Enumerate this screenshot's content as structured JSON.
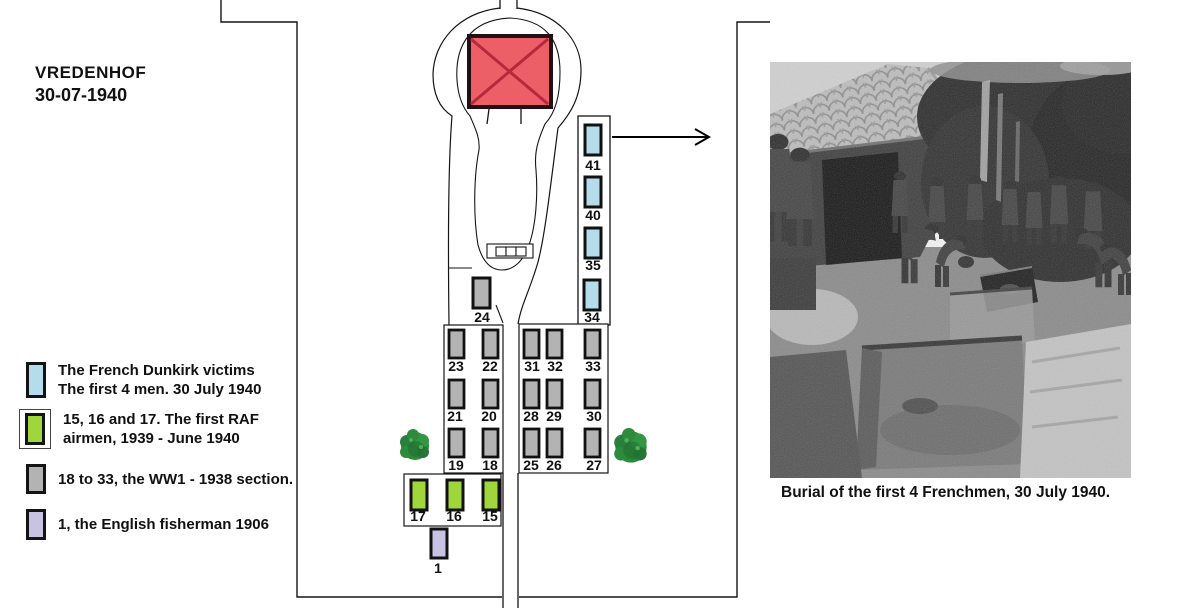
{
  "title": {
    "name": "VREDENHOF",
    "date": "30-07-1940"
  },
  "legend": {
    "items": [
      {
        "swatch": "french",
        "lines": [
          "The French Dunkirk victims",
          "The first 4 men. 30 July 1940"
        ]
      },
      {
        "swatch": "raf",
        "lines": [
          "15, 16 and 17. The first RAF",
          "airmen, 1939 - June 1940"
        ]
      },
      {
        "swatch": "ww1",
        "lines": [
          "18 to 33, the WW1 - 1938 section."
        ]
      },
      {
        "swatch": "fisherman",
        "lines": [
          "1, the English fisherman 1906"
        ]
      }
    ]
  },
  "map": {
    "colors": {
      "chapel": "#ed5f67",
      "chapel_cross": "#b5293a",
      "french": "#b5dcea",
      "raf": "#9fd63c",
      "ww1": "#b3b3b3",
      "fisherman": "#c9c3e3",
      "tree": "#2e8b3c"
    },
    "graves": {
      "blue_column": [
        "41",
        "40",
        "35",
        "34"
      ],
      "ww1_single": "24",
      "left_block": [
        [
          "23",
          "22"
        ],
        [
          "21",
          "20"
        ],
        [
          "19",
          "18"
        ]
      ],
      "right_block": [
        [
          "31",
          "32",
          "33"
        ],
        [
          "28",
          "29",
          "30"
        ],
        [
          "25",
          "26",
          "27"
        ]
      ],
      "raf_row": [
        "17",
        "16",
        "15"
      ],
      "fisherman": "1"
    }
  },
  "photo": {
    "caption": "Burial of the first 4 Frenchmen, 30 July 1940."
  }
}
